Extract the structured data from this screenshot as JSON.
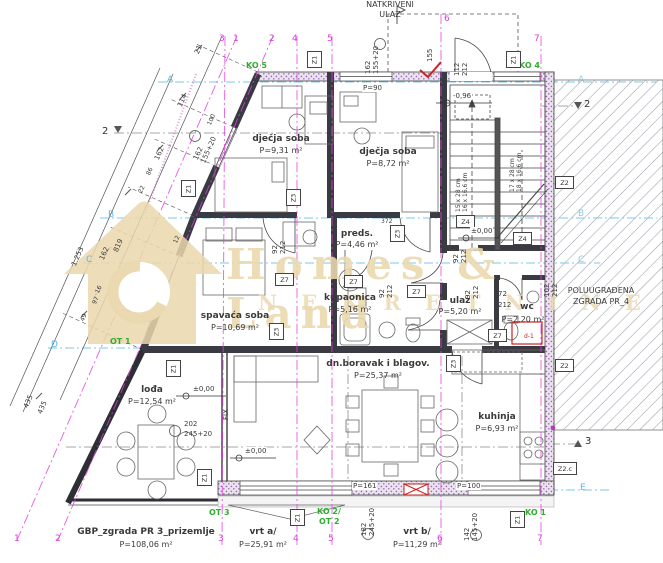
{
  "rooms": {
    "dj1": {
      "name": "dječja soba",
      "area": "P=9,31 m²"
    },
    "dj2": {
      "name": "dječja soba",
      "area": "P=8,72 m²"
    },
    "preds": {
      "name": "preds.",
      "area": "P=4,46 m²"
    },
    "spavaca": {
      "name": "spavaća soba",
      "area": "P=10,69 m²"
    },
    "kupaonica": {
      "name": "kupaonica",
      "area": "P=5,16 m²"
    },
    "ulaz": {
      "name": "ulaz",
      "area": "P=5,20 m²"
    },
    "wc": {
      "name": "wc",
      "area": "P=2,20 m²"
    },
    "loda": {
      "name": "lođa",
      "area": "P=12,54 m²"
    },
    "boravak": {
      "name": "dn.boravak i blagov.",
      "area": "P=25,37 m²"
    },
    "kuhinja": {
      "name": "kuhinja",
      "area": "P=6,93 m²"
    }
  },
  "site": {
    "entrance1": "NATKRIVENI",
    "entrance2": "ULAZ",
    "neighbor1": "POLUUGRAĐENA",
    "neighbor2": "ZGRADA PR_4",
    "gbp": {
      "name": "GBP_zgrada PR 3_prizemlje",
      "area": "P=108,06 m²"
    },
    "vrt_a": {
      "name": "vrt a/",
      "area": "P=25,91 m²"
    },
    "vrt_b": {
      "name": "vrt b/",
      "area": "P=11,29 m²"
    }
  },
  "axes": {
    "top": [
      "3",
      "1",
      "2",
      "4",
      "5",
      "6",
      "7"
    ],
    "bottom": [
      "1",
      "2",
      "3",
      "4",
      "5",
      "6",
      "7"
    ],
    "letters": {
      "a": "A",
      "b": "B",
      "c": "C",
      "d": "D",
      "e": "E"
    }
  },
  "markers": {
    "z1": "Z1",
    "z2": "Z2",
    "z2c": "Z2.c",
    "z3": "Z3",
    "z4": "Z4",
    "z7": "Z7",
    "d1": "d-1"
  },
  "green": {
    "ko5": "KO 5",
    "ko4": "KO 4",
    "ko1": "KO 1",
    "ko2": "KO 2/",
    "ot2": "OT 2",
    "ot3": "OT 3",
    "ot1": "OT 1"
  },
  "levels": {
    "zero": "±0,00",
    "minus": "-0,96"
  },
  "sections": {
    "s2": "2",
    "s3": "3"
  },
  "stairs": {
    "left": "15 x 28 cm\n16 x 16,6 cm",
    "right": "17 x 28 cm\n18 x 16,6 cm"
  },
  "dims": {
    "n21": "21",
    "n114": "114",
    "n162": "162",
    "n86": "86",
    "n22": "22",
    "n819": "819",
    "n16": "16",
    "n1253": "1.253",
    "n162b": "162",
    "n435a": "435",
    "n435b": "435",
    "n97": "97",
    "n49": "49",
    "n12": "12",
    "n100": "100",
    "win_slant": "162\n155+20",
    "win_top": "162\n155+20",
    "n155": "155",
    "entr": "112\n212",
    "door_a": "92\n212",
    "door_b": "92\n212",
    "door_c": "92\n212",
    "door_d": "92\n212",
    "door_e": "102\n212",
    "wc_w": "72",
    "wc_h": "212",
    "n372": "372",
    "p90": "P=90",
    "p161": "P=161",
    "p100": "P=100",
    "loda_w": "202",
    "loda_h": "245+20",
    "vrt": "182\n245+20",
    "kuh": "142\n145+20",
    "fix": "FIX"
  },
  "watermark": {
    "line1": "Homes & Land",
    "line2": "NEKRETNINE"
  }
}
